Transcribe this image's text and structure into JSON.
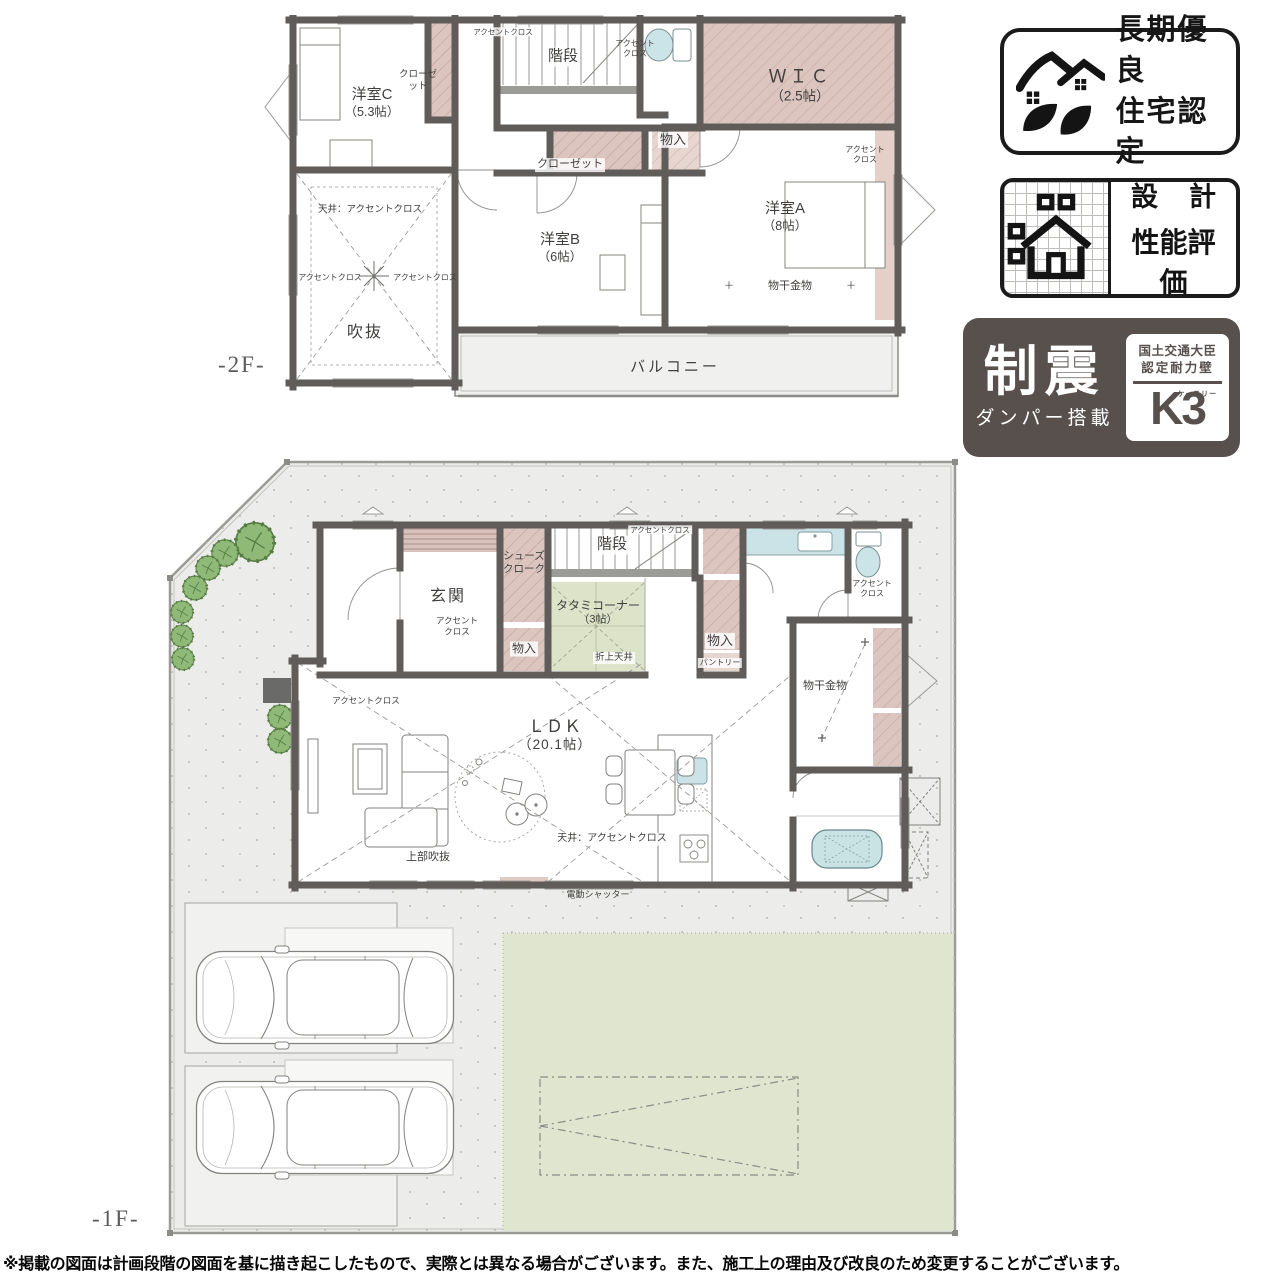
{
  "floor2": {
    "floor_label": "-2F-",
    "rooms": {
      "yoshitsu_c": [
        "洋室C",
        "（5.3帖）"
      ],
      "closet_c": [
        "クローゼ",
        "ット"
      ],
      "accent_top": "アクセントクロス",
      "stairs": "階段",
      "toilet_accent": [
        "アクセント",
        "クロス"
      ],
      "wic": [
        "ＷＩＣ",
        "（2.5帖）"
      ],
      "monoire": "物入",
      "closet_b": "クローゼット",
      "yoshitsu_b": [
        "洋室B",
        "（6帖）"
      ],
      "yoshitsu_a": [
        "洋室A",
        "（8帖）"
      ],
      "accent_a": [
        "アクセント",
        "クロス"
      ],
      "monohoshi": "物干金物",
      "plus_mark": "＋",
      "ceiling_accent": "天井：アクセントクロス",
      "accent_left": "アクセントクロス",
      "accent_right": "アクセントクロス",
      "fukinuke": "吹抜",
      "balcony": "バルコニー"
    }
  },
  "floor1": {
    "floor_label": "-1F-",
    "rooms": {
      "genkan": "玄関",
      "genkan_accent": [
        "アクセント",
        "クロス"
      ],
      "shoes_cloak": [
        "シューズ",
        "クローク"
      ],
      "stairs": "階段",
      "stairs_accent": "アクセントクロス",
      "tatami": [
        "タタミコーナー",
        "（3帖）"
      ],
      "oriage_tenjo": "折上天井",
      "monoire_left": "物入",
      "monoire_right": "物入",
      "pantry": "パントリー",
      "toilet_accent": [
        "アクセント",
        "クロス"
      ],
      "monohoshi": "物干金物",
      "ldk": [
        "ＬＤＫ",
        "（20.1帖）"
      ],
      "ceiling_accent": "天井：アクセントクロス",
      "upper_void": "上部吹抜",
      "accent_living": "アクセントクロス",
      "electric_shutter": "電動シャッター"
    }
  },
  "badges": {
    "choki": {
      "line1": "長期優良",
      "line2": "住宅認定"
    },
    "sekkei": {
      "word1": "設",
      "word2": "計",
      "line2": "性能評価"
    },
    "seishin": {
      "main": "制震",
      "sub": "ダンパー搭載",
      "cert1": "国土交通大臣",
      "cert2": "認定耐力壁",
      "k3": "K3",
      "kana": "ケースリー"
    }
  },
  "disclaimer": "※掲載の図面は計画段階の図面を基に描き起こしたもので、実際とは異なる場合がございます。また、施工上の理由及び改良のため変更することがございます。"
}
